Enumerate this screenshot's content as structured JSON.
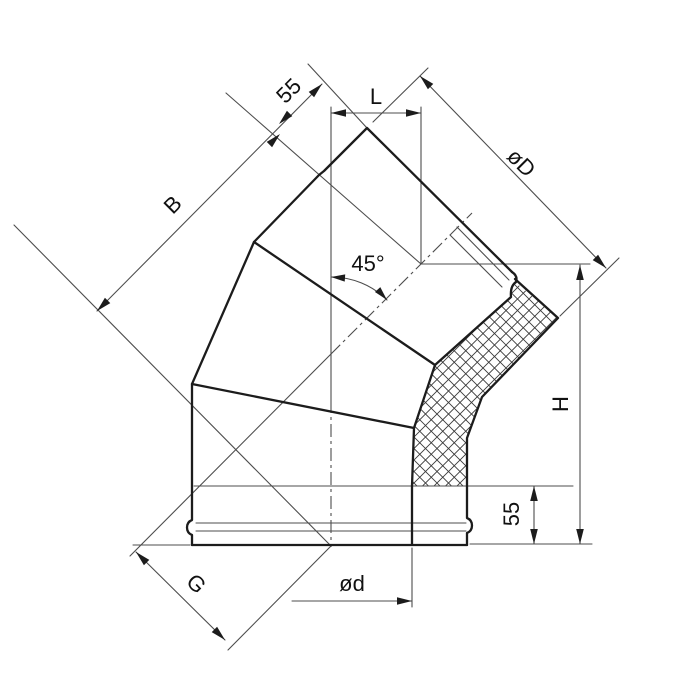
{
  "meta": {
    "description": "Engineering line drawing of a 45-degree insulated sandwich chimney elbow with dimension callouts",
    "background": "#ffffff"
  },
  "colors": {
    "outline": "#1c1c1c",
    "thin_lines": "#4d4d4d",
    "hatch": "#3a3a3a",
    "text": "#111111"
  },
  "dimensions": {
    "socket_top": {
      "label": "55",
      "meaning": "top spigot length"
    },
    "offset": {
      "label": "L",
      "meaning": "horizontal offset between axes"
    },
    "outer_diameter": {
      "label": "øD",
      "meaning": "outer shell diameter"
    },
    "side_length": {
      "label": "B",
      "meaning": "side length along axis"
    },
    "angle": {
      "label": "45°",
      "meaning": "bend angle"
    },
    "height": {
      "label": "H",
      "meaning": "overall height"
    },
    "socket_bottom": {
      "label": "55",
      "meaning": "bottom socket length"
    },
    "gore_length": {
      "label": "G",
      "meaning": "lower diagonal dimension"
    },
    "inner_diameter": {
      "label": "ød",
      "meaning": "inner pipe diameter"
    }
  }
}
